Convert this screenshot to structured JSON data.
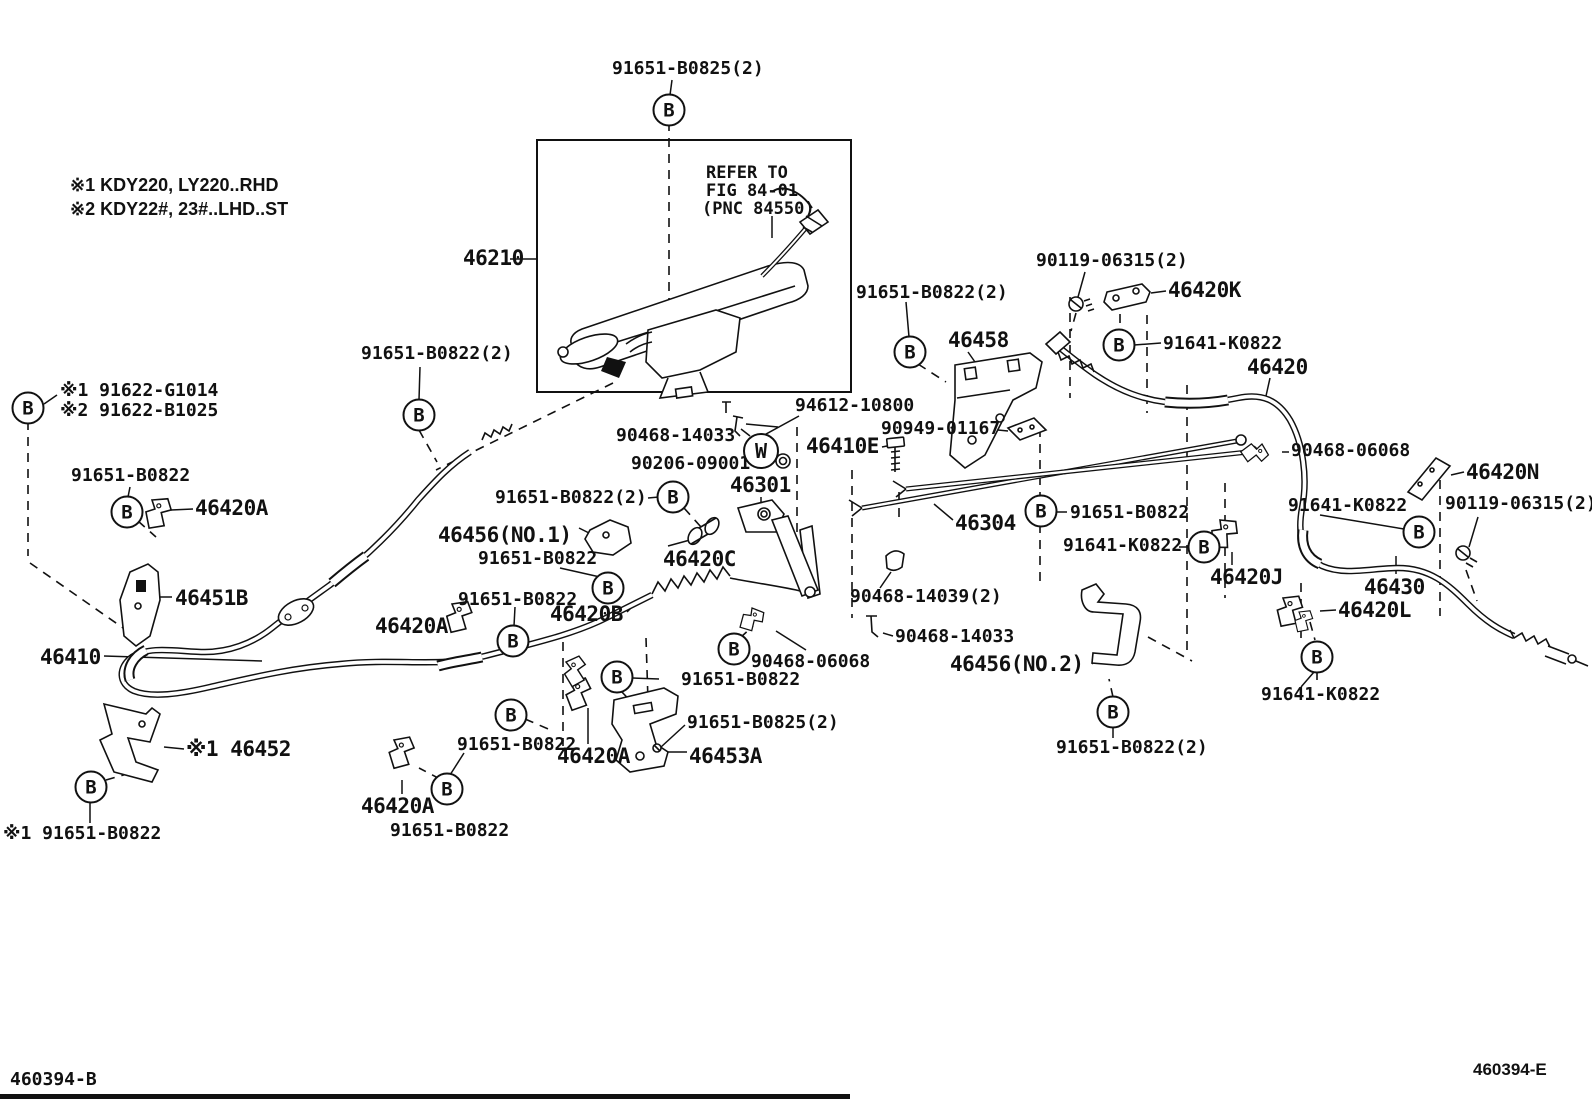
{
  "diagram": {
    "notes": {
      "n1": "※1 KDY220, LY220..RHD",
      "n2": "※2 KDY22#, 23#..LHD..ST"
    },
    "refer": {
      "l1": "REFER TO",
      "l2": "FIG 84-01",
      "l3": "(PNC 84550)"
    },
    "callouts": {
      "b": "B",
      "w": "W"
    },
    "footer": {
      "left": "460394-B",
      "right": "460394-E"
    },
    "labels": [
      {
        "text": "91651-B0825(2)"
      },
      {
        "text": "※1 KDY220, LY220..RHD"
      },
      {
        "text": "※2 KDY22#, 23#..LHD..ST"
      },
      {
        "text": "REFER TO"
      },
      {
        "text": "FIG 84-01"
      },
      {
        "text": "(PNC 84550)"
      },
      {
        "text": "46210"
      },
      {
        "text": "91651-B0822(2)"
      },
      {
        "text": "90119-06315(2)"
      },
      {
        "text": "46420K"
      },
      {
        "text": "91651-B0822(2)"
      },
      {
        "text": "46458"
      },
      {
        "text": "91641-K0822"
      },
      {
        "text": "46420"
      },
      {
        "text": "※1 91622-G1014"
      },
      {
        "text": "※2 91622-B1025"
      },
      {
        "text": "94612-10800"
      },
      {
        "text": "90468-14033"
      },
      {
        "text": "46410E"
      },
      {
        "text": "90949-01167"
      },
      {
        "text": "90206-09001"
      },
      {
        "text": "46301"
      },
      {
        "text": "91651-B0822"
      },
      {
        "text": "46420A"
      },
      {
        "text": "91651-B0822(2)"
      },
      {
        "text": "46456(NO.1)"
      },
      {
        "text": "91651-B0822"
      },
      {
        "text": "46420C"
      },
      {
        "text": "46304"
      },
      {
        "text": "91651-B0822"
      },
      {
        "text": "90468-06068"
      },
      {
        "text": "46420N"
      },
      {
        "text": "91641-K0822"
      },
      {
        "text": "90119-06315(2)"
      },
      {
        "text": "91641-K0822"
      },
      {
        "text": "46420J"
      },
      {
        "text": "46451B"
      },
      {
        "text": "46420A"
      },
      {
        "text": "91651-B0822"
      },
      {
        "text": "46420B"
      },
      {
        "text": "46410"
      },
      {
        "text": "90468-14039(2)"
      },
      {
        "text": "90468-14033"
      },
      {
        "text": "90468-06068"
      },
      {
        "text": "91651-B0822"
      },
      {
        "text": "46456(NO.2)"
      },
      {
        "text": "46430"
      },
      {
        "text": "46420L"
      },
      {
        "text": "91641-K0822"
      },
      {
        "text": "※1 46452"
      },
      {
        "text": "91651-B0822"
      },
      {
        "text": "46420A"
      },
      {
        "text": "46453A"
      },
      {
        "text": "91651-B0825(2)"
      },
      {
        "text": "91651-B0822(2)"
      },
      {
        "text": "46420A"
      },
      {
        "text": "91651-B0822"
      },
      {
        "text": "※1 91651-B0822"
      },
      {
        "text": "460394-B"
      },
      {
        "text": "460394-E"
      }
    ]
  }
}
